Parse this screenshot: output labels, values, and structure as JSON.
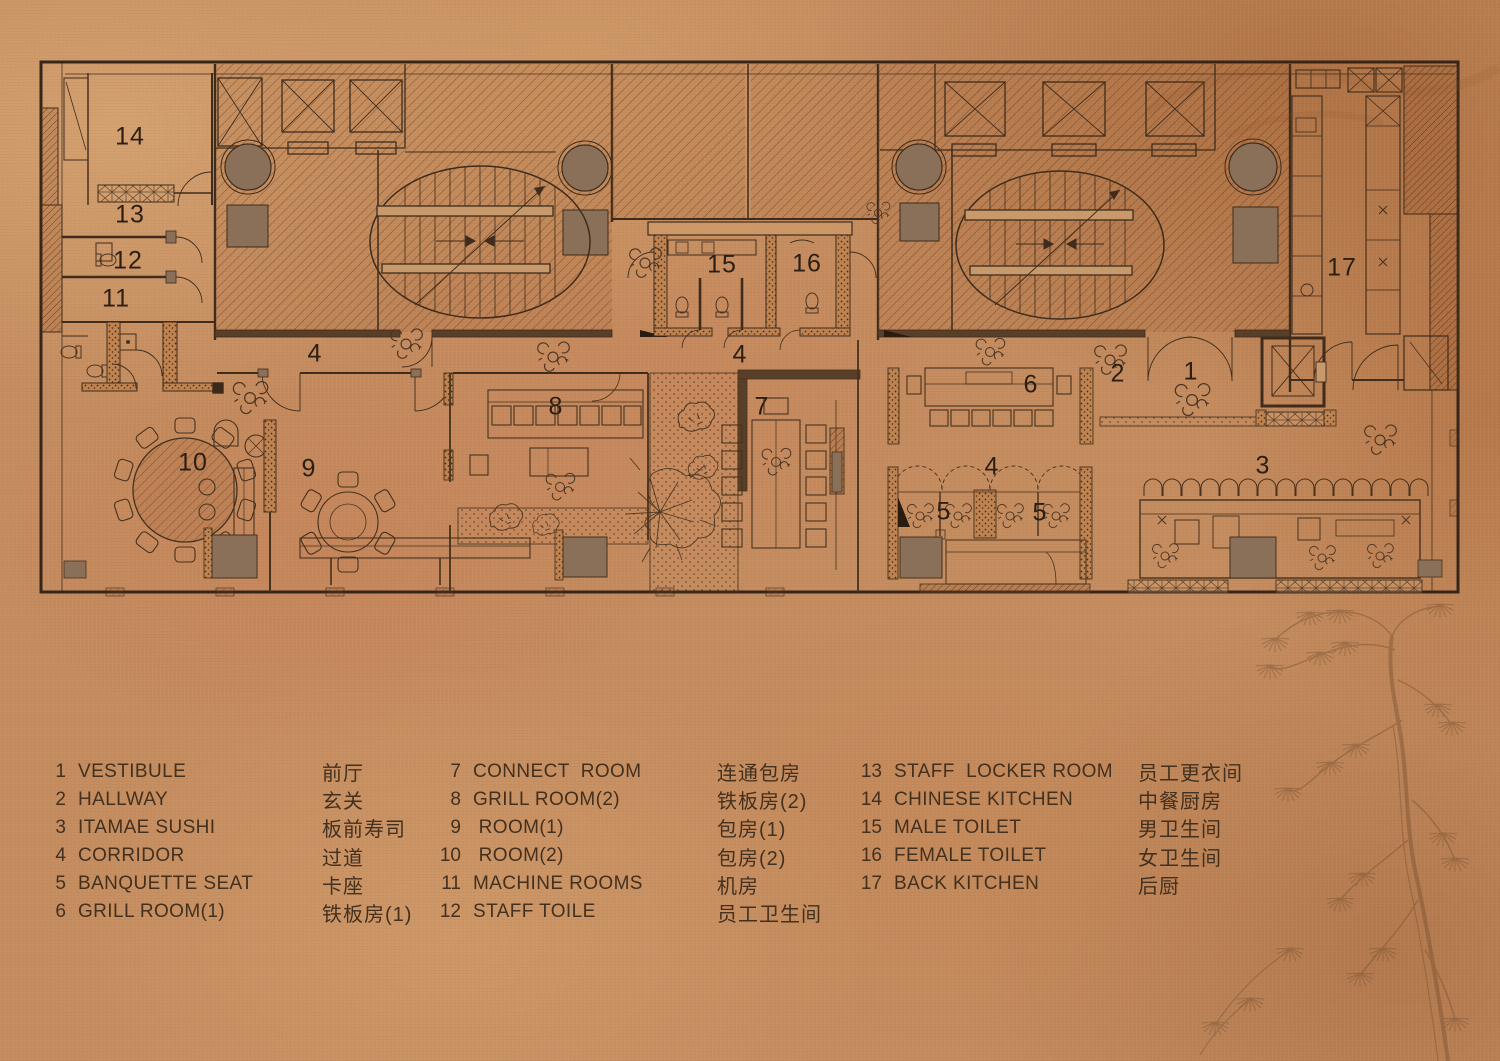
{
  "title": "restaurant floor plan",
  "colors": {
    "background": "#c48c5f",
    "wall_line": "#3a2818",
    "solid_fill": "#8a7058",
    "text": "#43301f",
    "plan_number": "#2b1e12"
  },
  "plan": {
    "labels": [
      {
        "name": "chinese-kitchen",
        "text": "14"
      },
      {
        "name": "staff-locker-room",
        "text": "13"
      },
      {
        "name": "staff-toilet",
        "text": "12"
      },
      {
        "name": "machine-rooms",
        "text": "11"
      },
      {
        "name": "corridor-west",
        "text": "4"
      },
      {
        "name": "room-2",
        "text": "10"
      },
      {
        "name": "room-1",
        "text": "9"
      },
      {
        "name": "grill-room-2",
        "text": "8"
      },
      {
        "name": "male-toilet",
        "text": "15"
      },
      {
        "name": "female-toilet",
        "text": "16"
      },
      {
        "name": "corridor-mid",
        "text": "4"
      },
      {
        "name": "connect-room",
        "text": "7"
      },
      {
        "name": "grill-room-1",
        "text": "6"
      },
      {
        "name": "hallway",
        "text": "2"
      },
      {
        "name": "vestibule",
        "text": "1"
      },
      {
        "name": "corridor-east",
        "text": "4"
      },
      {
        "name": "banquette-seat-a",
        "text": "5"
      },
      {
        "name": "banquette-seat-b",
        "text": "5"
      },
      {
        "name": "itamae-sushi",
        "text": "3"
      },
      {
        "name": "back-kitchen",
        "text": "17"
      }
    ]
  },
  "legend": {
    "col1": [
      {
        "num": "1",
        "en": "VESTIBULE",
        "zh": "前厅"
      },
      {
        "num": "2",
        "en": "HALLWAY",
        "zh": "玄关"
      },
      {
        "num": "3",
        "en": "ITAMAE SUSHI",
        "zh": "板前寿司"
      },
      {
        "num": "4",
        "en": "CORRIDOR",
        "zh": "过道"
      },
      {
        "num": "5",
        "en": "BANQUETTE SEAT",
        "zh": "卡座"
      },
      {
        "num": "6",
        "en": "GRILL ROOM(1)",
        "zh": "铁板房(1)"
      }
    ],
    "col2": [
      {
        "num": "7",
        "en": "CONNECT  ROOM",
        "zh": "连通包房"
      },
      {
        "num": "8",
        "en": "GRILL ROOM(2)",
        "zh": "铁板房(2)"
      },
      {
        "num": "9",
        "en": " ROOM(1)",
        "zh": "包房(1)"
      },
      {
        "num": "10",
        "en": " ROOM(2)",
        "zh": "包房(2)"
      },
      {
        "num": "11",
        "en": "MACHINE ROOMS",
        "zh": "机房"
      },
      {
        "num": "12",
        "en": "STAFF TOILE",
        "zh": "员工卫生间"
      }
    ],
    "col3": [
      {
        "num": "13",
        "en": "STAFF  LOCKER ROOM",
        "zh": "员工更衣间"
      },
      {
        "num": "14",
        "en": "CHINESE KITCHEN",
        "zh": "中餐厨房"
      },
      {
        "num": "15",
        "en": "MALE TOILET",
        "zh": "男卫生间"
      },
      {
        "num": "16",
        "en": "FEMALE TOILET",
        "zh": "女卫生间"
      },
      {
        "num": "17",
        "en": "BACK KITCHEN",
        "zh": "后厨"
      }
    ]
  }
}
